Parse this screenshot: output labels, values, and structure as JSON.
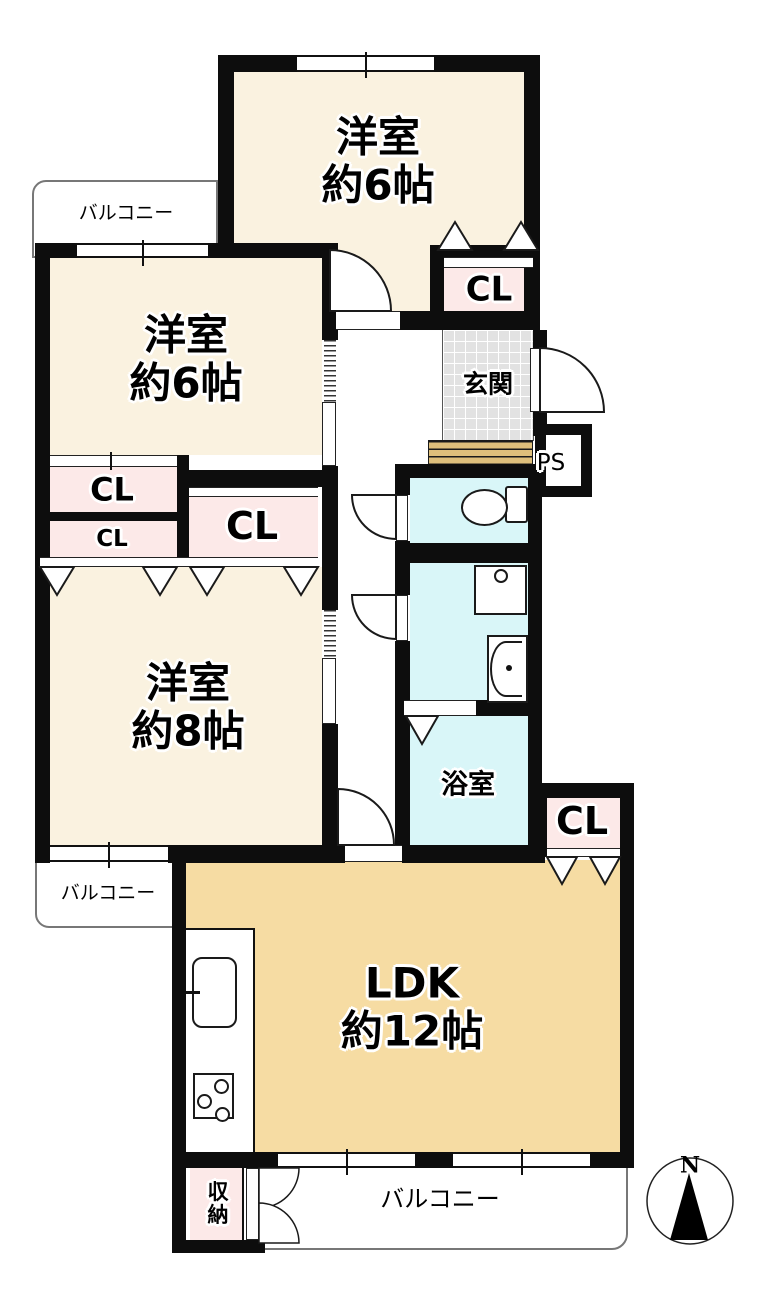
{
  "colors": {
    "wall": "#0d0d0d",
    "room_cream": "#faf2e0",
    "ldk_tan": "#f6dca3",
    "closet_pink": "#fce9e8",
    "wet_blue": "#d9f6f8",
    "tile_gray": "#e2e2e2",
    "step_tan": "#debf7b"
  },
  "rooms": {
    "bedroom_top": {
      "label": "洋室\n約6帖"
    },
    "bedroom_left": {
      "label": "洋室\n約6帖"
    },
    "bedroom_big": {
      "label": "洋室\n約8帖"
    },
    "ldk": {
      "label": "LDK\n約12帖"
    },
    "entrance": {
      "label": "玄関"
    },
    "bath": {
      "label": "浴室"
    },
    "storage": {
      "label": "収\n納"
    }
  },
  "closets": {
    "top": "CL",
    "left_upper": "CL",
    "left_lower": "CL",
    "center": "CL",
    "ldk": "CL"
  },
  "pipe_space": {
    "label": "PS"
  },
  "balconies": {
    "top_left": "バルコニー",
    "mid_left": "バルコニー",
    "bottom": "バルコニー"
  },
  "compass": {
    "label": "N"
  }
}
